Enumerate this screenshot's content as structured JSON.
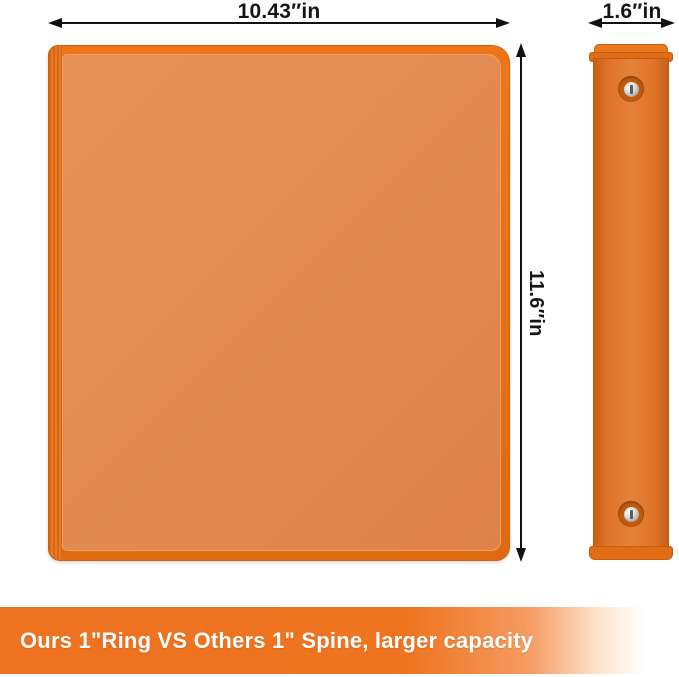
{
  "dimensions": {
    "front_width": "10.43″in",
    "front_height": "11.6″in",
    "spine_width": "1.6″in"
  },
  "banner": {
    "text": "Ours 1\"Ring VS Others 1\" Spine, larger capacity",
    "background_color": "#ee7220",
    "text_color": "#ffffff"
  },
  "product": {
    "item": "orange-3-ring-binder",
    "colors": {
      "cover_edge": "#e8701a",
      "cover_panel": "#e28b52",
      "spine_face": "#dd7226",
      "rivet_metal": "#c9c9c9",
      "dimension_line": "#111111"
    }
  }
}
